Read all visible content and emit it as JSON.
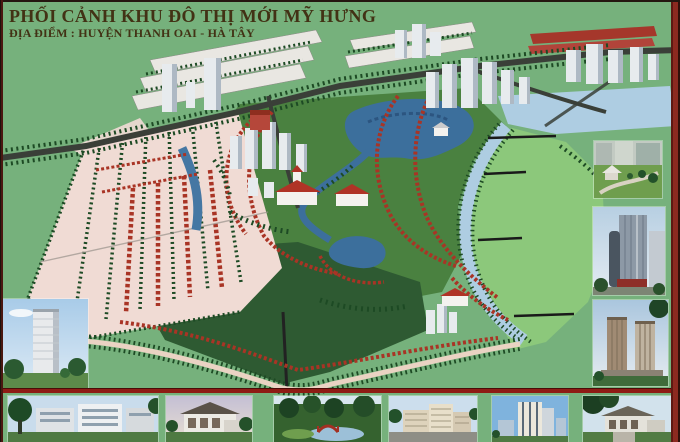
{
  "poster": {
    "title": "PHỐI CẢNH KHU ĐÔ THỊ MỚI MỸ HƯNG",
    "subtitle": "ĐỊA ĐIỂM : HUYỆN THANH OAI - HÀ TÂY"
  },
  "colors": {
    "background": "#76b17c",
    "title_text": "#423215",
    "border_dark": "#241710",
    "accent_maroon": "#8c2a20",
    "separator_red": "#8e1b14",
    "water_lake": "#3c6f9c",
    "water_river": "#aecde2",
    "field_green": "#8cc87b",
    "park_green": "#2e5a32",
    "villa_red": "#a93425",
    "road_dark": "#3a3f38",
    "path_pink": "#f2dcd6"
  },
  "main_plan": {
    "description": "Aerial perspective rendering of My Hung new urban area: villa grid, lakes, winding river, meadow, tower clusters and tree-lined roads"
  },
  "thumbnails": {
    "right_column": [
      {
        "id": "garden-courtyard",
        "label": "Garden courtyard perspective"
      },
      {
        "id": "highrise-tower",
        "label": "High-rise tower perspective"
      },
      {
        "id": "twin-towers",
        "label": "Twin apartment towers perspective"
      }
    ],
    "bottom_left": {
      "id": "tower-park",
      "label": "Apartment tower in park perspective"
    },
    "bottom_row": [
      {
        "id": "apartment-block",
        "label": "Low-rise apartment block perspective"
      },
      {
        "id": "modern-villa",
        "label": "Modern villa perspective"
      },
      {
        "id": "park-bridge",
        "label": "Park and bridge landscape perspective"
      },
      {
        "id": "midrise-complex",
        "label": "Mid-rise complex perspective"
      },
      {
        "id": "city-highrise",
        "label": "City high-rise perspective"
      },
      {
        "id": "villa-estate",
        "label": "Villa estate perspective"
      }
    ]
  }
}
